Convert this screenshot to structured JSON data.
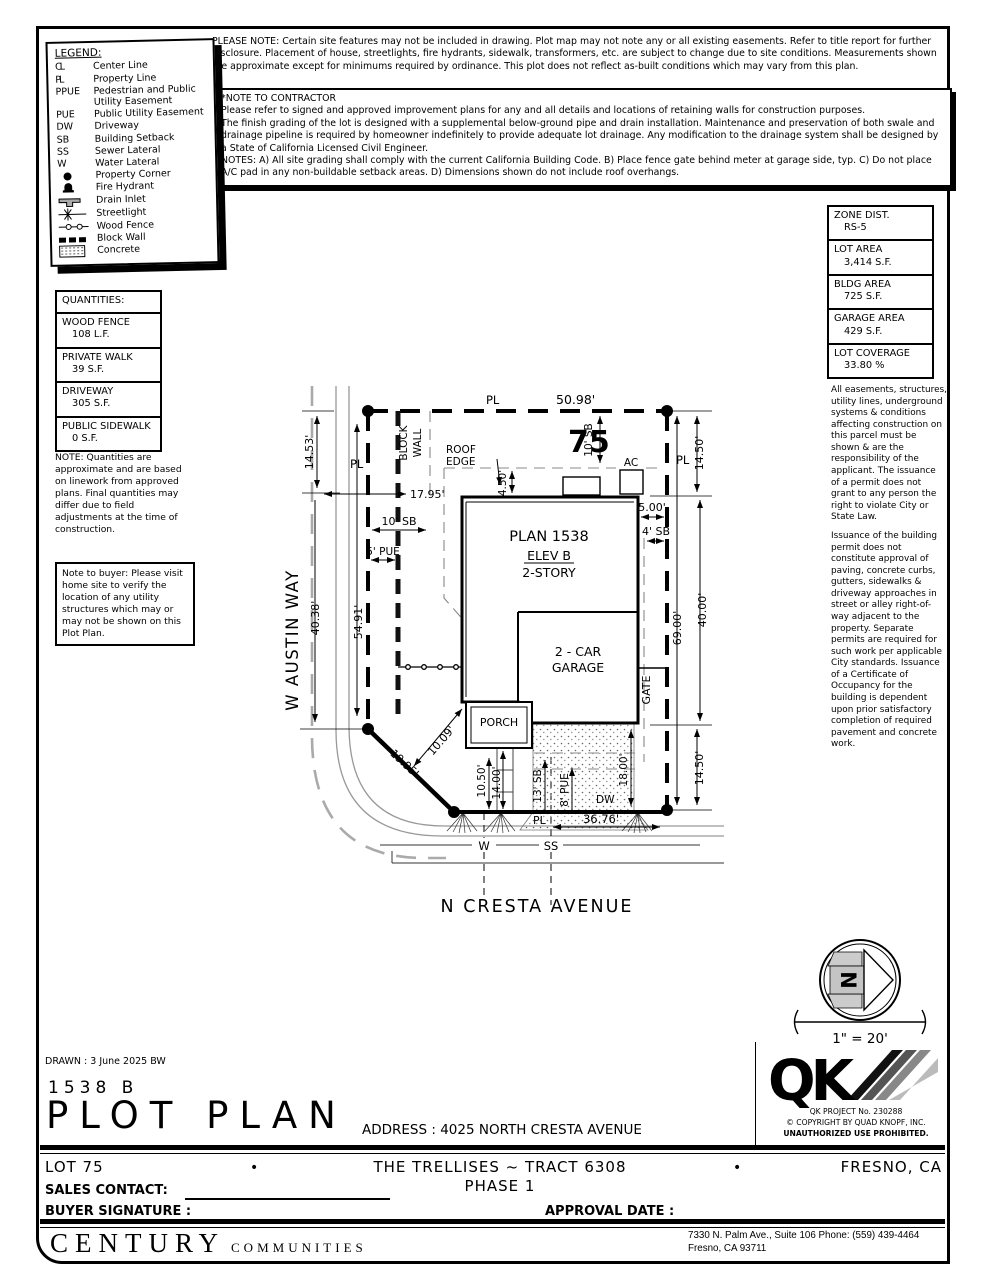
{
  "page": {
    "drawn": "DRAWN :  3 June 2025  BW",
    "model": "1538  B",
    "title": "PLOT PLAN",
    "address_label": "ADDRESS :  4025 NORTH CRESTA AVENUE"
  },
  "top_note": "PLEASE NOTE:  Certain site features may not be included in drawing.  Plot map may not note any or all existing easements.  Refer to title report for further disclosure.  Placement of house, streetlights, fire hydrants, sidewalk, transformers, etc. are subject to change due to site conditions.  Measurements shown are approximate except for minimums required by ordinance.  This plot does not reflect as-built conditions which may vary from this plan.",
  "contractor_note": {
    "title": "*NOTE TO CONTRACTOR",
    "p1": "Please refer to signed and approved improvement plans for any and all details and locations of retaining walls for construction purposes.",
    "p2": "The finish grading of the lot is designed with a supplemental below-ground pipe and drain installation.  Maintenance and preservation of both swale and drainage pipeline is required by homeowner indefinitely to provide adequate lot drainage.  Any modification to the drainage system shall be designed by a State of California Licensed Civil Engineer.",
    "p3": "NOTES:  A) All site grading shall comply with the current California Building Code.  B) Place fence gate behind meter at garage side, typ.  C) Do not place A/C pad in any non-buildable setback areas.  D) Dimensions shown do not include roof overhangs."
  },
  "legend": {
    "title": "LEGEND:",
    "items": [
      {
        "sym": "CL",
        "label": "Center Line"
      },
      {
        "sym": "PL",
        "label": "Property Line"
      },
      {
        "sym": "PPUE",
        "label": "Pedestrian and Public Utility Easement"
      },
      {
        "sym": "PUE",
        "label": "Public Utility Easement"
      },
      {
        "sym": "DW",
        "label": "Driveway"
      },
      {
        "sym": "SB",
        "label": "Building Setback"
      },
      {
        "sym": "SS",
        "label": "Sewer Lateral"
      },
      {
        "sym": "W",
        "label": "Water Lateral"
      },
      {
        "icon": "property-corner-dot",
        "label": "Property Corner"
      },
      {
        "icon": "fire-hydrant-icon",
        "label": "Fire Hydrant"
      },
      {
        "icon": "drain-inlet-icon",
        "label": "Drain Inlet"
      },
      {
        "icon": "streetlight-icon",
        "label": "Streetlight"
      },
      {
        "icon": "wood-fence-icon",
        "label": "Wood Fence"
      },
      {
        "icon": "block-wall-icon",
        "label": "Block Wall"
      },
      {
        "icon": "concrete-icon",
        "label": "Concrete"
      }
    ]
  },
  "quantities": {
    "title": "QUANTITIES:",
    "rows": [
      {
        "name": "WOOD FENCE",
        "value": "108 L.F."
      },
      {
        "name": "PRIVATE WALK",
        "value": "39 S.F."
      },
      {
        "name": "DRIVEWAY",
        "value": "305 S.F."
      },
      {
        "name": "PUBLIC SIDEWALK",
        "value": "0 S.F."
      }
    ],
    "note": "NOTE: Quantities are approximate and are based on linework from approved plans.  Final quantities may differ due to field adjustments at the time of construction.",
    "buyer_note": "Note to buyer: Please visit home site to verify the location of any utility structures which may or may not be shown on this Plot Plan."
  },
  "zoning": {
    "rows": [
      {
        "name": "ZONE DIST.",
        "value": "RS-5"
      },
      {
        "name": "LOT AREA",
        "value": "3,414 S.F."
      },
      {
        "name": "BLDG AREA",
        "value": "725 S.F."
      },
      {
        "name": "GARAGE AREA",
        "value": "429 S.F."
      },
      {
        "name": "LOT COVERAGE",
        "value": "33.80 %"
      }
    ],
    "note1": "All easements, structures, utility lines, underground systems & conditions affecting construction on this parcel must be shown & are the responsibility of the applicant. The issuance of a permit does not grant to any person the right to violate City or State Law.",
    "note2": "Issuance of the building permit does not constitute approval of paving, concrete curbs, gutters, sidewalks & driveway approaches in street or alley right-of-way adjacent to the property. Separate permits are required for such work per applicable City standards. Issuance of a Certificate of Occupancy for the building is dependent upon prior satisfactory completion of required pavement and concrete work."
  },
  "plot": {
    "lot_number": "75",
    "streets": {
      "left": "W AUSTIN WAY",
      "bottom": "N CRESTA AVENUE"
    },
    "plan": {
      "line1": "PLAN 1538",
      "line2": "ELEV B",
      "line3": "2-STORY"
    },
    "garage": {
      "line1": "2 - CAR",
      "line2": "GARAGE"
    },
    "labels": {
      "pl": "PL",
      "porch": "PORCH",
      "gate": "GATE",
      "ac": "AC",
      "dw": "DW",
      "w": "W",
      "ss": "SS",
      "roof1": "ROOF",
      "roof2": "EDGE",
      "block1": "BLOCK",
      "block2": "WALL"
    },
    "dims": {
      "top": "50.98'",
      "left_top": "14.53'",
      "left_pl": "54.91'",
      "left_street": "40.38'",
      "right_top": "14.50'",
      "right_mid": "40.00'",
      "right_total": "69.00'",
      "right_bottom": "14.50'",
      "sb10_top": "10' SB",
      "sb10_side": "10' SB",
      "pue5": "5' PUE",
      "d1795": "17.95'",
      "d450": "4.50'",
      "d500": "5.00'",
      "sb4": "4' SB",
      "diag_pl": "19.95'",
      "diag": "10.09'",
      "d1050": "10.50'",
      "d1400": "14.00'",
      "sb13": "13' SB",
      "pue8": "8' PUE",
      "d1800": "18.00'",
      "d3676": "36.76'"
    }
  },
  "north": {
    "letter": "N",
    "scale": "1\" = 20'"
  },
  "qk": {
    "logo": "QK",
    "project": "QK PROJECT No. 230288",
    "copyright": "©  COPYRIGHT BY QUAD KNOPF, INC.",
    "rights": "UNAUTHORIZED USE PROHIBITED."
  },
  "footer": {
    "lot": "LOT 75",
    "bullet": "•",
    "tract": "THE TRELLISES ~ TRACT 6308",
    "phase": "PHASE 1",
    "city": "FRESNO, CA",
    "sales_label": "SALES CONTACT:",
    "buyer_label": "BUYER SIGNATURE :",
    "approval_label": "APPROVAL DATE :",
    "brand": "CENTURY",
    "brand2": "COMMUNITIES",
    "addr1": "7330 N. Palm Ave., Suite 106    Phone:  (559) 439-4464",
    "addr2": "Fresno, CA  93711"
  }
}
